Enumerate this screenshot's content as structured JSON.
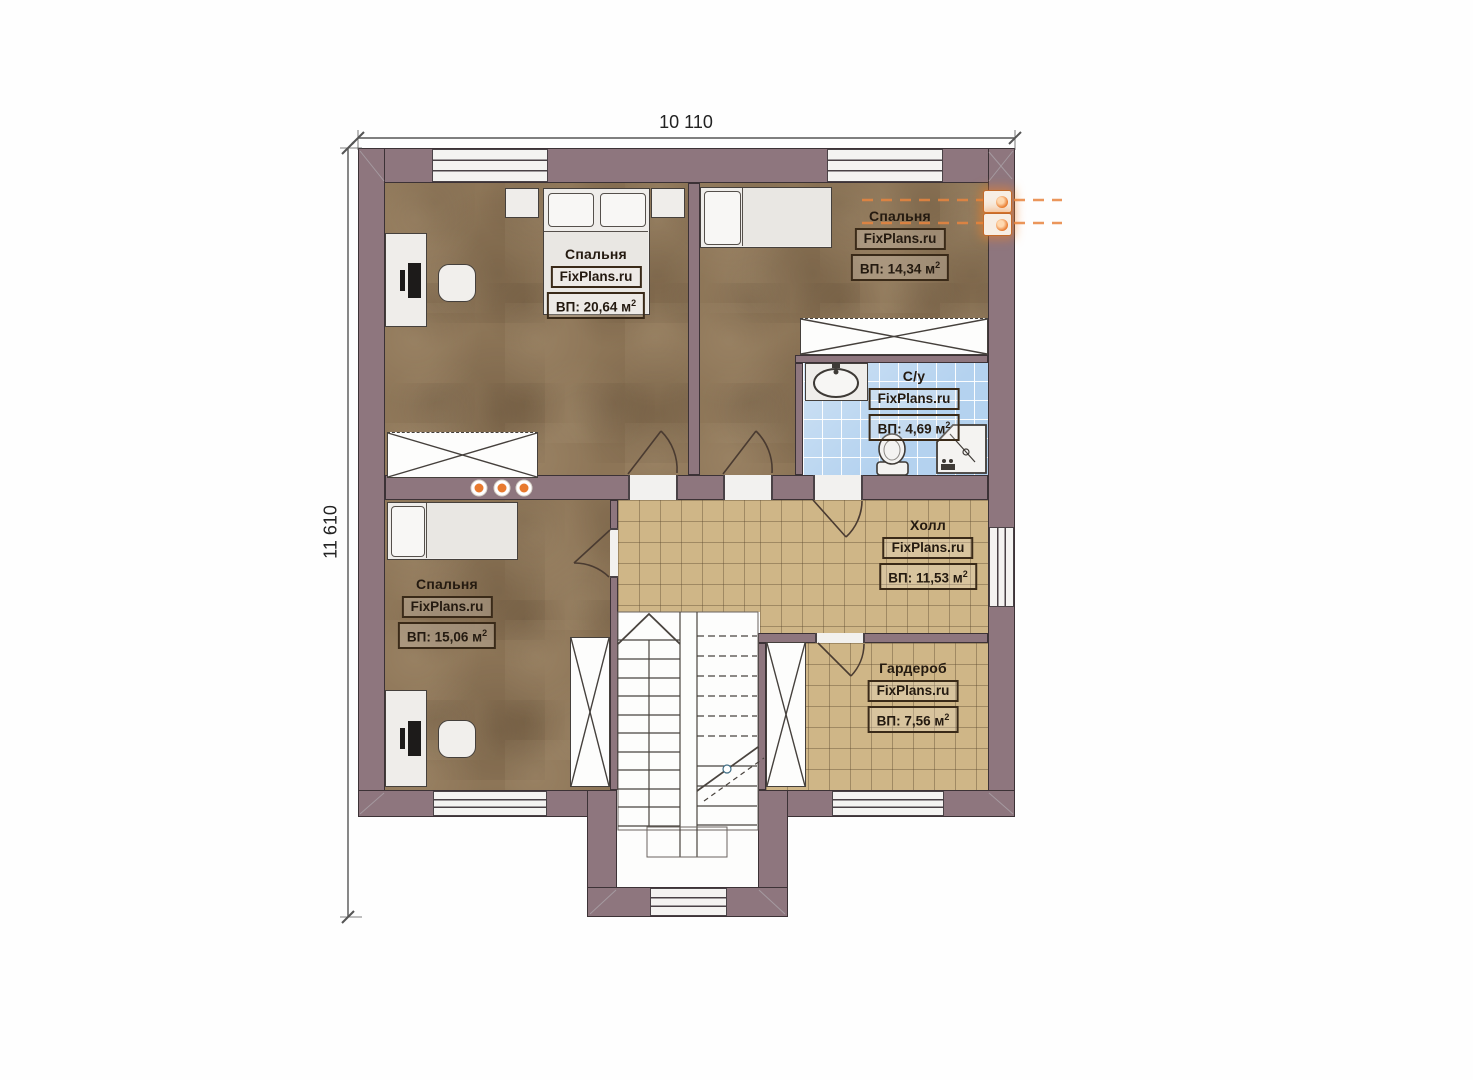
{
  "title": "Floor plan — second level",
  "brand": "FixPlans.ru",
  "dimensions": {
    "top": "10 110",
    "left": "11 610"
  },
  "rooms": [
    {
      "id": "bedroom-top-left",
      "title": "Спальня",
      "brand": "FixPlans.ru",
      "area": "ВП: 20,64 м",
      "area_sup": "2"
    },
    {
      "id": "bedroom-top-right",
      "title": "Спальня",
      "brand": "FixPlans.ru",
      "area": "ВП: 14,34 м",
      "area_sup": "2"
    },
    {
      "id": "bathroom",
      "title": "С/у",
      "brand": "FixPlans.ru",
      "area": "ВП: 4,69 м",
      "area_sup": "2"
    },
    {
      "id": "hall",
      "title": "Холл",
      "brand": "FixPlans.ru",
      "area": "ВП: 11,53 м",
      "area_sup": "2"
    },
    {
      "id": "bedroom-bottom-left",
      "title": "Спальня",
      "brand": "FixPlans.ru",
      "area": "ВП: 15,06 м",
      "area_sup": "2"
    },
    {
      "id": "wardrobe-room",
      "title": "Гардероб",
      "brand": "FixPlans.ru",
      "area": "ВП: 7,56 м",
      "area_sup": "2"
    }
  ],
  "colors": {
    "wall": "#8e767e",
    "floor_wood": "#8d7557",
    "floor_tile_tan": "#cfb687",
    "floor_tile_blue": "#b4d2ef",
    "accent_orange": "#e87a2e",
    "line_dark": "#3c3236"
  },
  "icons": {
    "heating": "radiator-icon",
    "lights": "ceiling-light-icon",
    "stairs": "staircase-icon"
  }
}
